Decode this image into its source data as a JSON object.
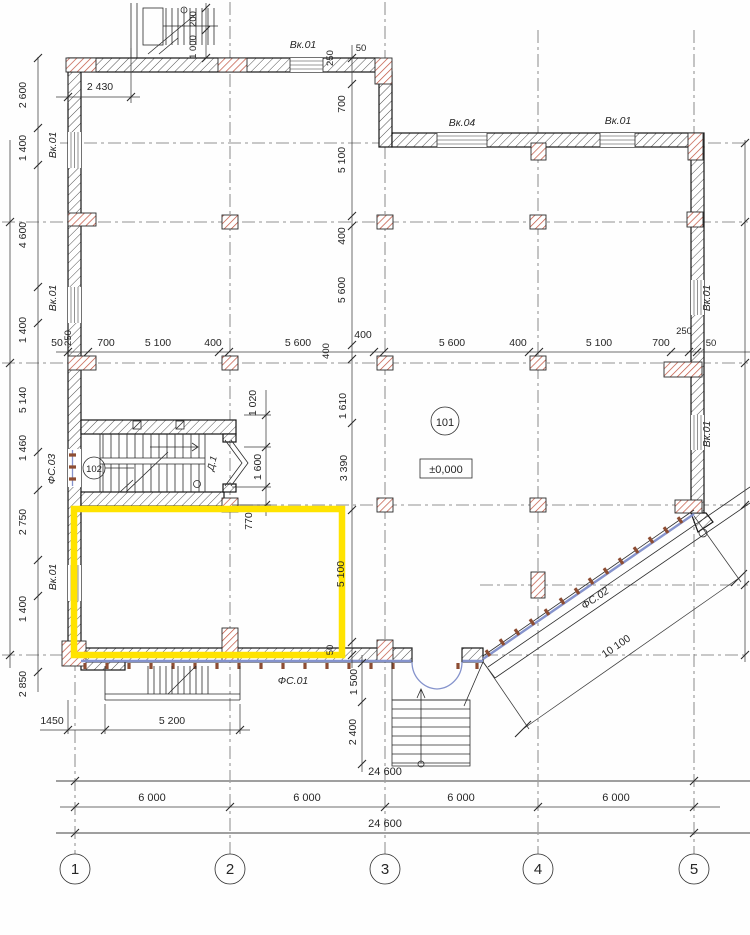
{
  "colors": {
    "highlight": "#ffe300",
    "column_hatch": "#c0503c",
    "facade_blue": "#8593cc",
    "mullion_brown": "#8d4d33"
  },
  "labels": {
    "axes": [
      "1",
      "2",
      "3",
      "4",
      "5"
    ],
    "rooms": {
      "hall": "101",
      "stair": "102",
      "elev": "±0,000",
      "door": "Д.1"
    },
    "win": {
      "top": "Вк.01",
      "up1": "Вк.04",
      "up2": "Вк.01",
      "l1": "Вк.01",
      "l2": "Вк.01",
      "l4": "Вк.01",
      "r1": "Вк.01",
      "r2": "Вк.01"
    },
    "fac": {
      "f1": "ФС.01",
      "f2": "ФС.02",
      "f3": "ФС.03"
    },
    "dims": {
      "top": [
        "2 430",
        "200",
        "1 000"
      ],
      "left": [
        "2 600",
        "1 400",
        "4 600",
        "1 400",
        "5 140",
        "1 460",
        "2 750",
        "1 400",
        "2 850"
      ],
      "mid": [
        "50",
        "700",
        "5 100",
        "400",
        "5 600",
        "400",
        "5 600",
        "400",
        "5 100",
        "700",
        "250",
        "50"
      ],
      "midrot": [
        "250",
        "400"
      ],
      "ax3": [
        "250",
        "50",
        "700",
        "5 100",
        "400",
        "5 600",
        "1 610",
        "3 390",
        "5 100",
        "50"
      ],
      "stair": [
        "1 020",
        "1 600",
        "770"
      ],
      "entry": [
        "1 500",
        "2 400"
      ],
      "porch": [
        "1450",
        "5 200"
      ],
      "diag": "10 100",
      "overall": [
        "24 600",
        "24 600"
      ],
      "spans": [
        "6 000",
        "6 000",
        "6 000",
        "6 000"
      ]
    }
  }
}
